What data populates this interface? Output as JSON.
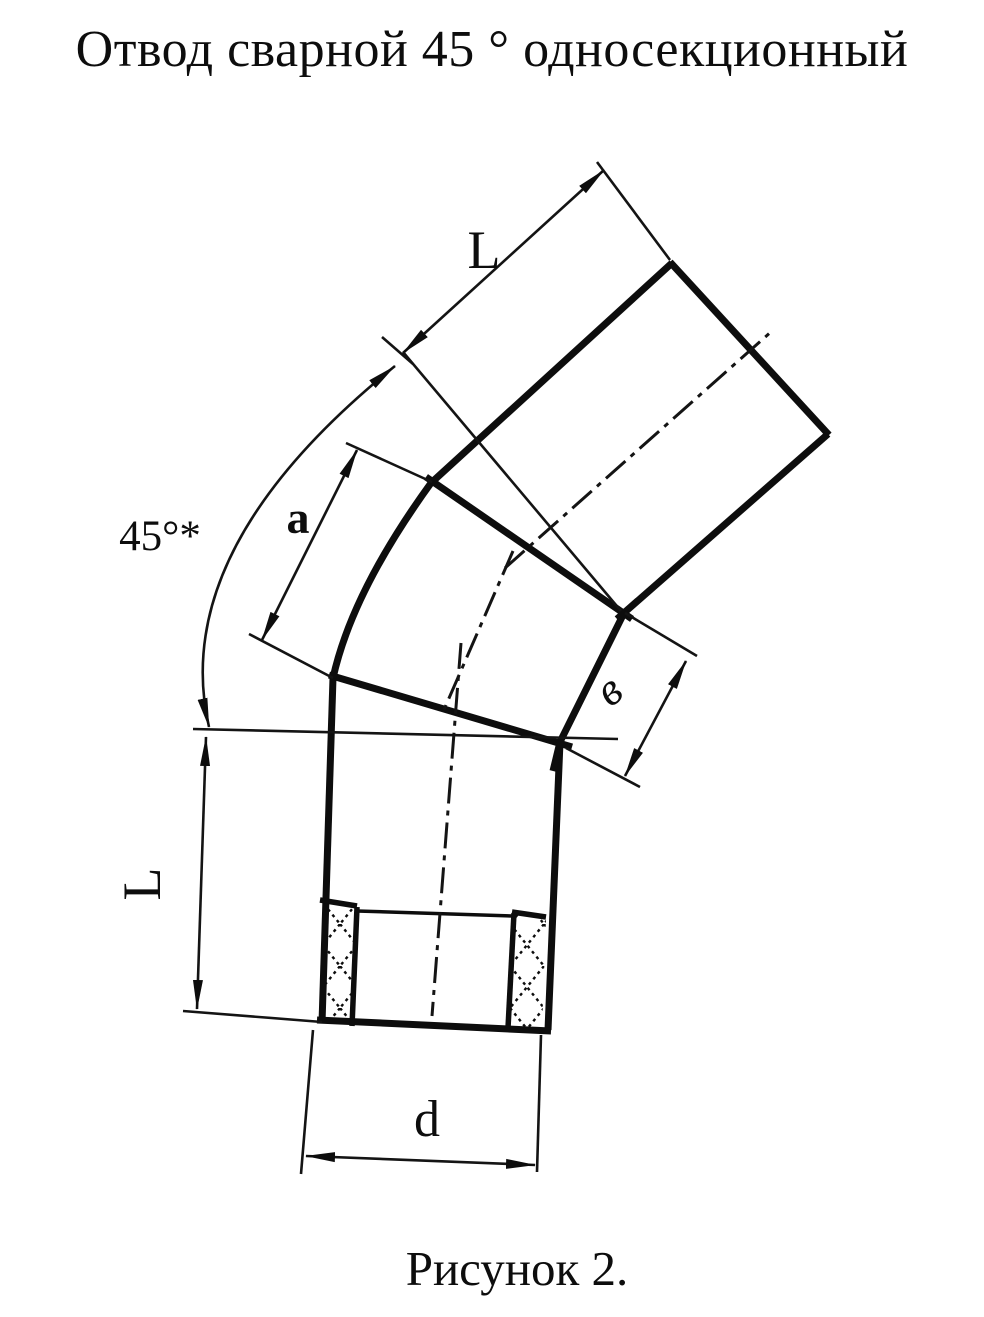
{
  "title": "Отвод сварной 45 ° односекционный",
  "caption": "Рисунок 2.",
  "labels": {
    "top_length": "L",
    "angle": "45°*",
    "segment_a": "a",
    "width_v": "в",
    "left_length": "L",
    "diameter_d": "d"
  },
  "colors": {
    "ink": "#0d0d0d",
    "paper": "#ffffff"
  }
}
